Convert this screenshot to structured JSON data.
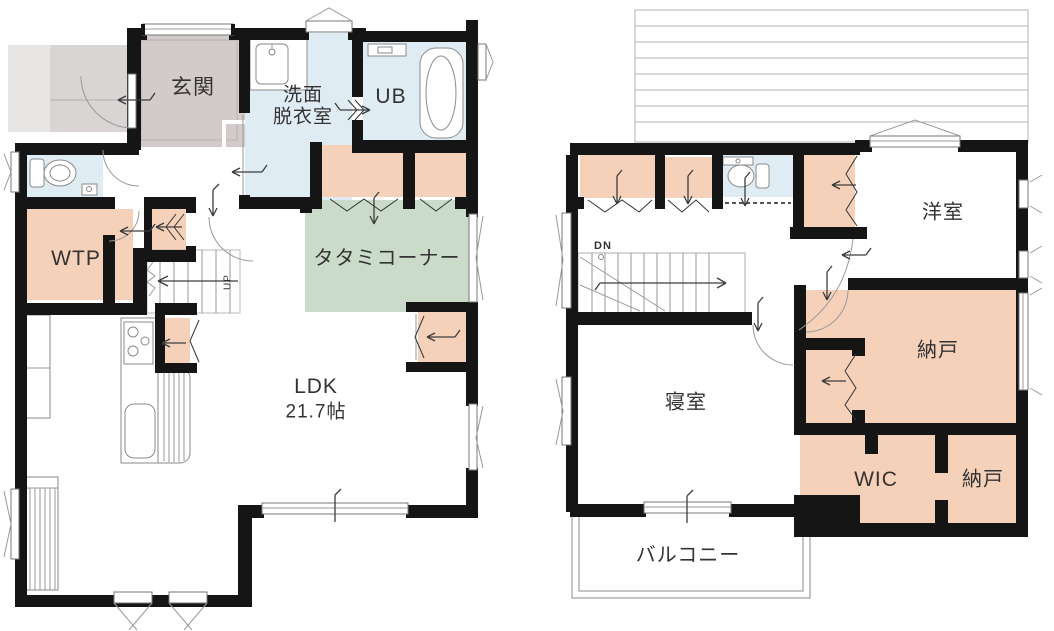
{
  "colors": {
    "wall": "#151515",
    "peach": "#f5d1ba",
    "blue": "#e0ecf4",
    "green": "#cbdbc9",
    "genkan": "#d2cbca",
    "porch": "#d9d5d5",
    "porchlight": "#e8e5e5"
  },
  "floor1": {
    "labels": {
      "genkan": "玄関",
      "senmen_line1": "洗面",
      "senmen_line2": "脱衣室",
      "ub": "UB",
      "wtp": "WTP",
      "tatami": "タタミコーナー",
      "ldk": "LDK",
      "ldk_size": "21.7帖",
      "up": "UP"
    }
  },
  "floor2": {
    "labels": {
      "dn": "DN",
      "yoshitsu": "洋室",
      "nando_upper": "納戸",
      "shinshitsu": "寝室",
      "wic": "WIC",
      "nando_lower": "納戸",
      "balcony": "バルコニー"
    }
  }
}
